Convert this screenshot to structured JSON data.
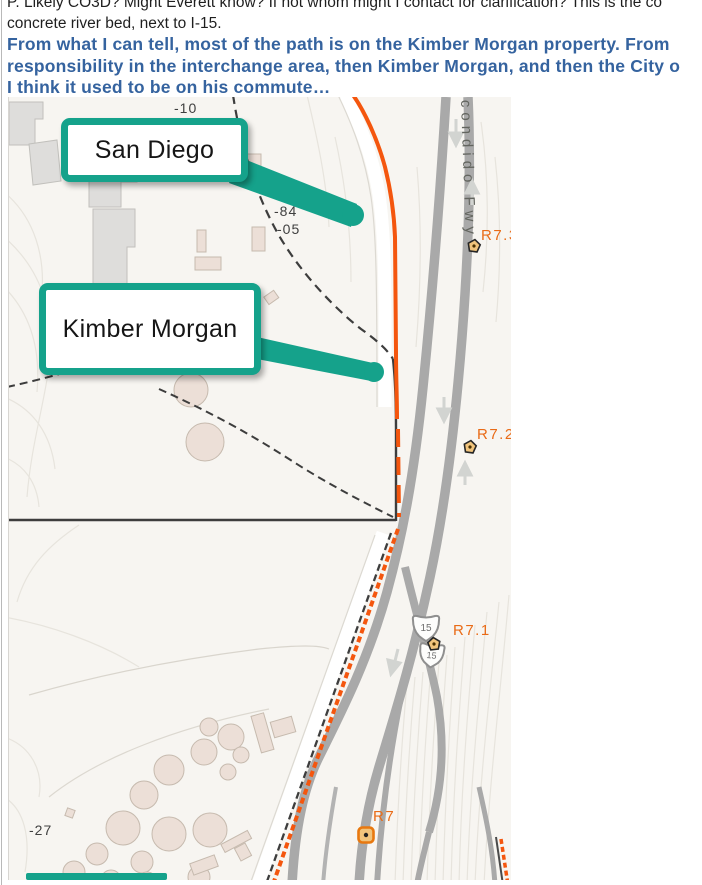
{
  "document": {
    "line1": "P.  Likely CO3D?  Might Everett know?  If not whom might I contact for clarification?  This is the co",
    "line2": "concrete river bed, next to I-15.",
    "emphasis_line1": " From what I can tell, most of the path is on the Kimber Morgan property.  From",
    "emphasis_line2": "responsibility in the interchange area, then Kimber Morgan, and then the City o",
    "emphasis_line3": "I think it used to be on his commute…"
  },
  "map": {
    "callouts": [
      {
        "label": "San Diego"
      },
      {
        "label": "Kimber Morgan"
      }
    ],
    "road_label": "condido Fwy",
    "route_shield": "15",
    "markers": [
      {
        "label": "R7.3"
      },
      {
        "label": "R7.2"
      },
      {
        "label": "R7.1"
      },
      {
        "label": "R7"
      }
    ],
    "elevations": [
      {
        "text": "-10"
      },
      {
        "text": "-84"
      },
      {
        "text": "-05"
      },
      {
        "text": "-27"
      }
    ],
    "colors": {
      "callout_teal": "#15a28b",
      "route_orange": "#f4560e",
      "marker_label_orange": "#e96b17",
      "freeway_gray": "#a9a9a9",
      "emphasis_blue": "#35639f"
    }
  }
}
